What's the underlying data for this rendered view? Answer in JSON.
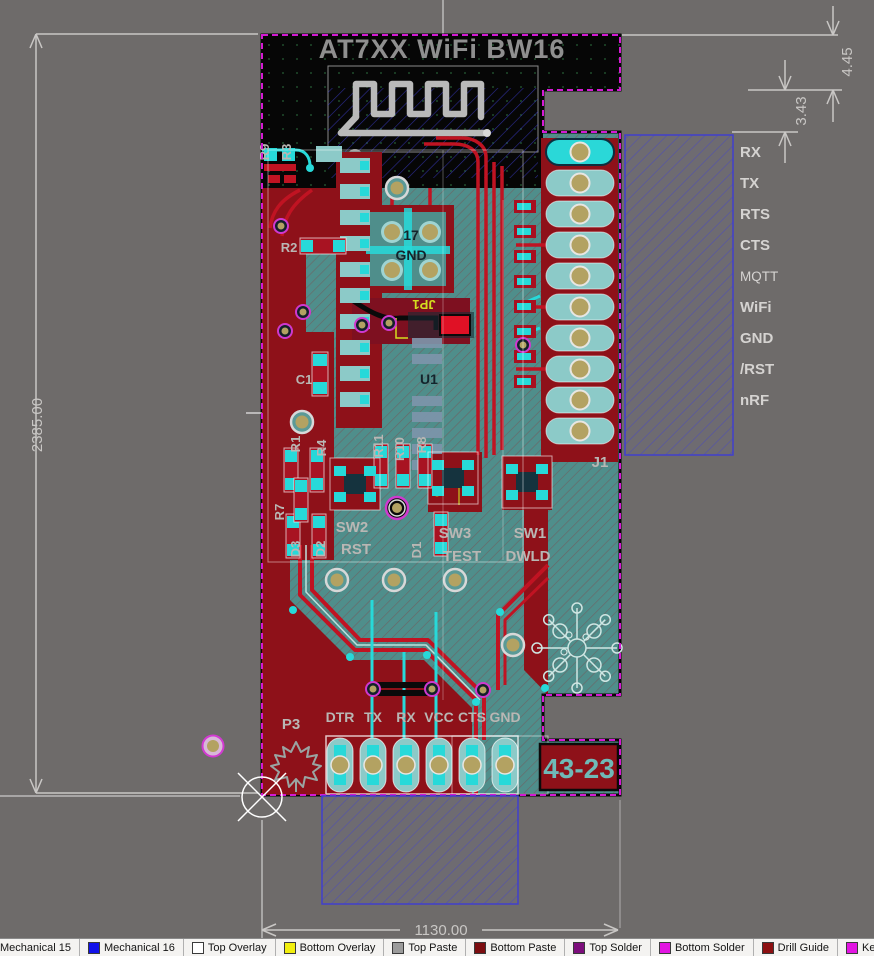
{
  "dimensions": {
    "board_height": "2385.00",
    "board_width": "1130.00",
    "notch_offset": "4.45",
    "notch_height": "3.43"
  },
  "silkscreen": {
    "title": "AT7XX WiFi BW16",
    "connector_pins": [
      "RX",
      "TX",
      "RTS",
      "CTS",
      "MQTT",
      "WiFi",
      "GND",
      "/RST",
      "nRF"
    ],
    "header_pins": [
      "DTR",
      "TX",
      "RX",
      "VCC",
      "CTS",
      "GND"
    ],
    "designators": {
      "r9": "R9",
      "r3": "R3",
      "r2": "R2",
      "c1": "C1",
      "r1": "R1",
      "r4": "R4",
      "r7": "R7",
      "r11": "R11",
      "r10": "R10",
      "r8": "R8",
      "d3": "D3",
      "d2": "D2",
      "d1": "D1",
      "u1": "U1",
      "jp1": "JP1",
      "j1": "J1",
      "p3": "P3",
      "sw2": "SW2",
      "sw2_label": "RST",
      "sw3": "SW3",
      "sw3_label": "TEST",
      "sw1": "SW1",
      "sw1_label": "DWLD",
      "pad17": "17",
      "pad17_net": "GND",
      "board_code": "43-23"
    }
  },
  "layer_tabs": [
    {
      "label": "Mechanical 15",
      "color": ""
    },
    {
      "label": "Mechanical 16",
      "color": "#1111e8"
    },
    {
      "label": "Top Overlay",
      "color": "#ffffff"
    },
    {
      "label": "Bottom Overlay",
      "color": "#f2ef0e"
    },
    {
      "label": "Top Paste",
      "color": "#9b9b9b"
    },
    {
      "label": "Bottom Paste",
      "color": "#7c0d10"
    },
    {
      "label": "Top Solder",
      "color": "#7c0e7c"
    },
    {
      "label": "Bottom Solder",
      "color": "#e214e2"
    },
    {
      "label": "Drill Guide",
      "color": "#8c1012"
    },
    {
      "label": "Kee",
      "color": "#e214e2"
    }
  ],
  "colors": {
    "background": "#6e6b6a",
    "board_teal": "#4f8e8b",
    "pour_red": "#8e1119",
    "trace_red": "#c01322",
    "pad_cyan": "#27d9d9",
    "pad_teal": "#8ccac8",
    "hole_tan": "#b3a262",
    "keepout_black": "#060606",
    "outline_magenta": "#d319d3",
    "hatch_blue": "#3b3bd8",
    "silk_gray": "#b9b7b4",
    "dim_gray": "#c9c7c5"
  }
}
